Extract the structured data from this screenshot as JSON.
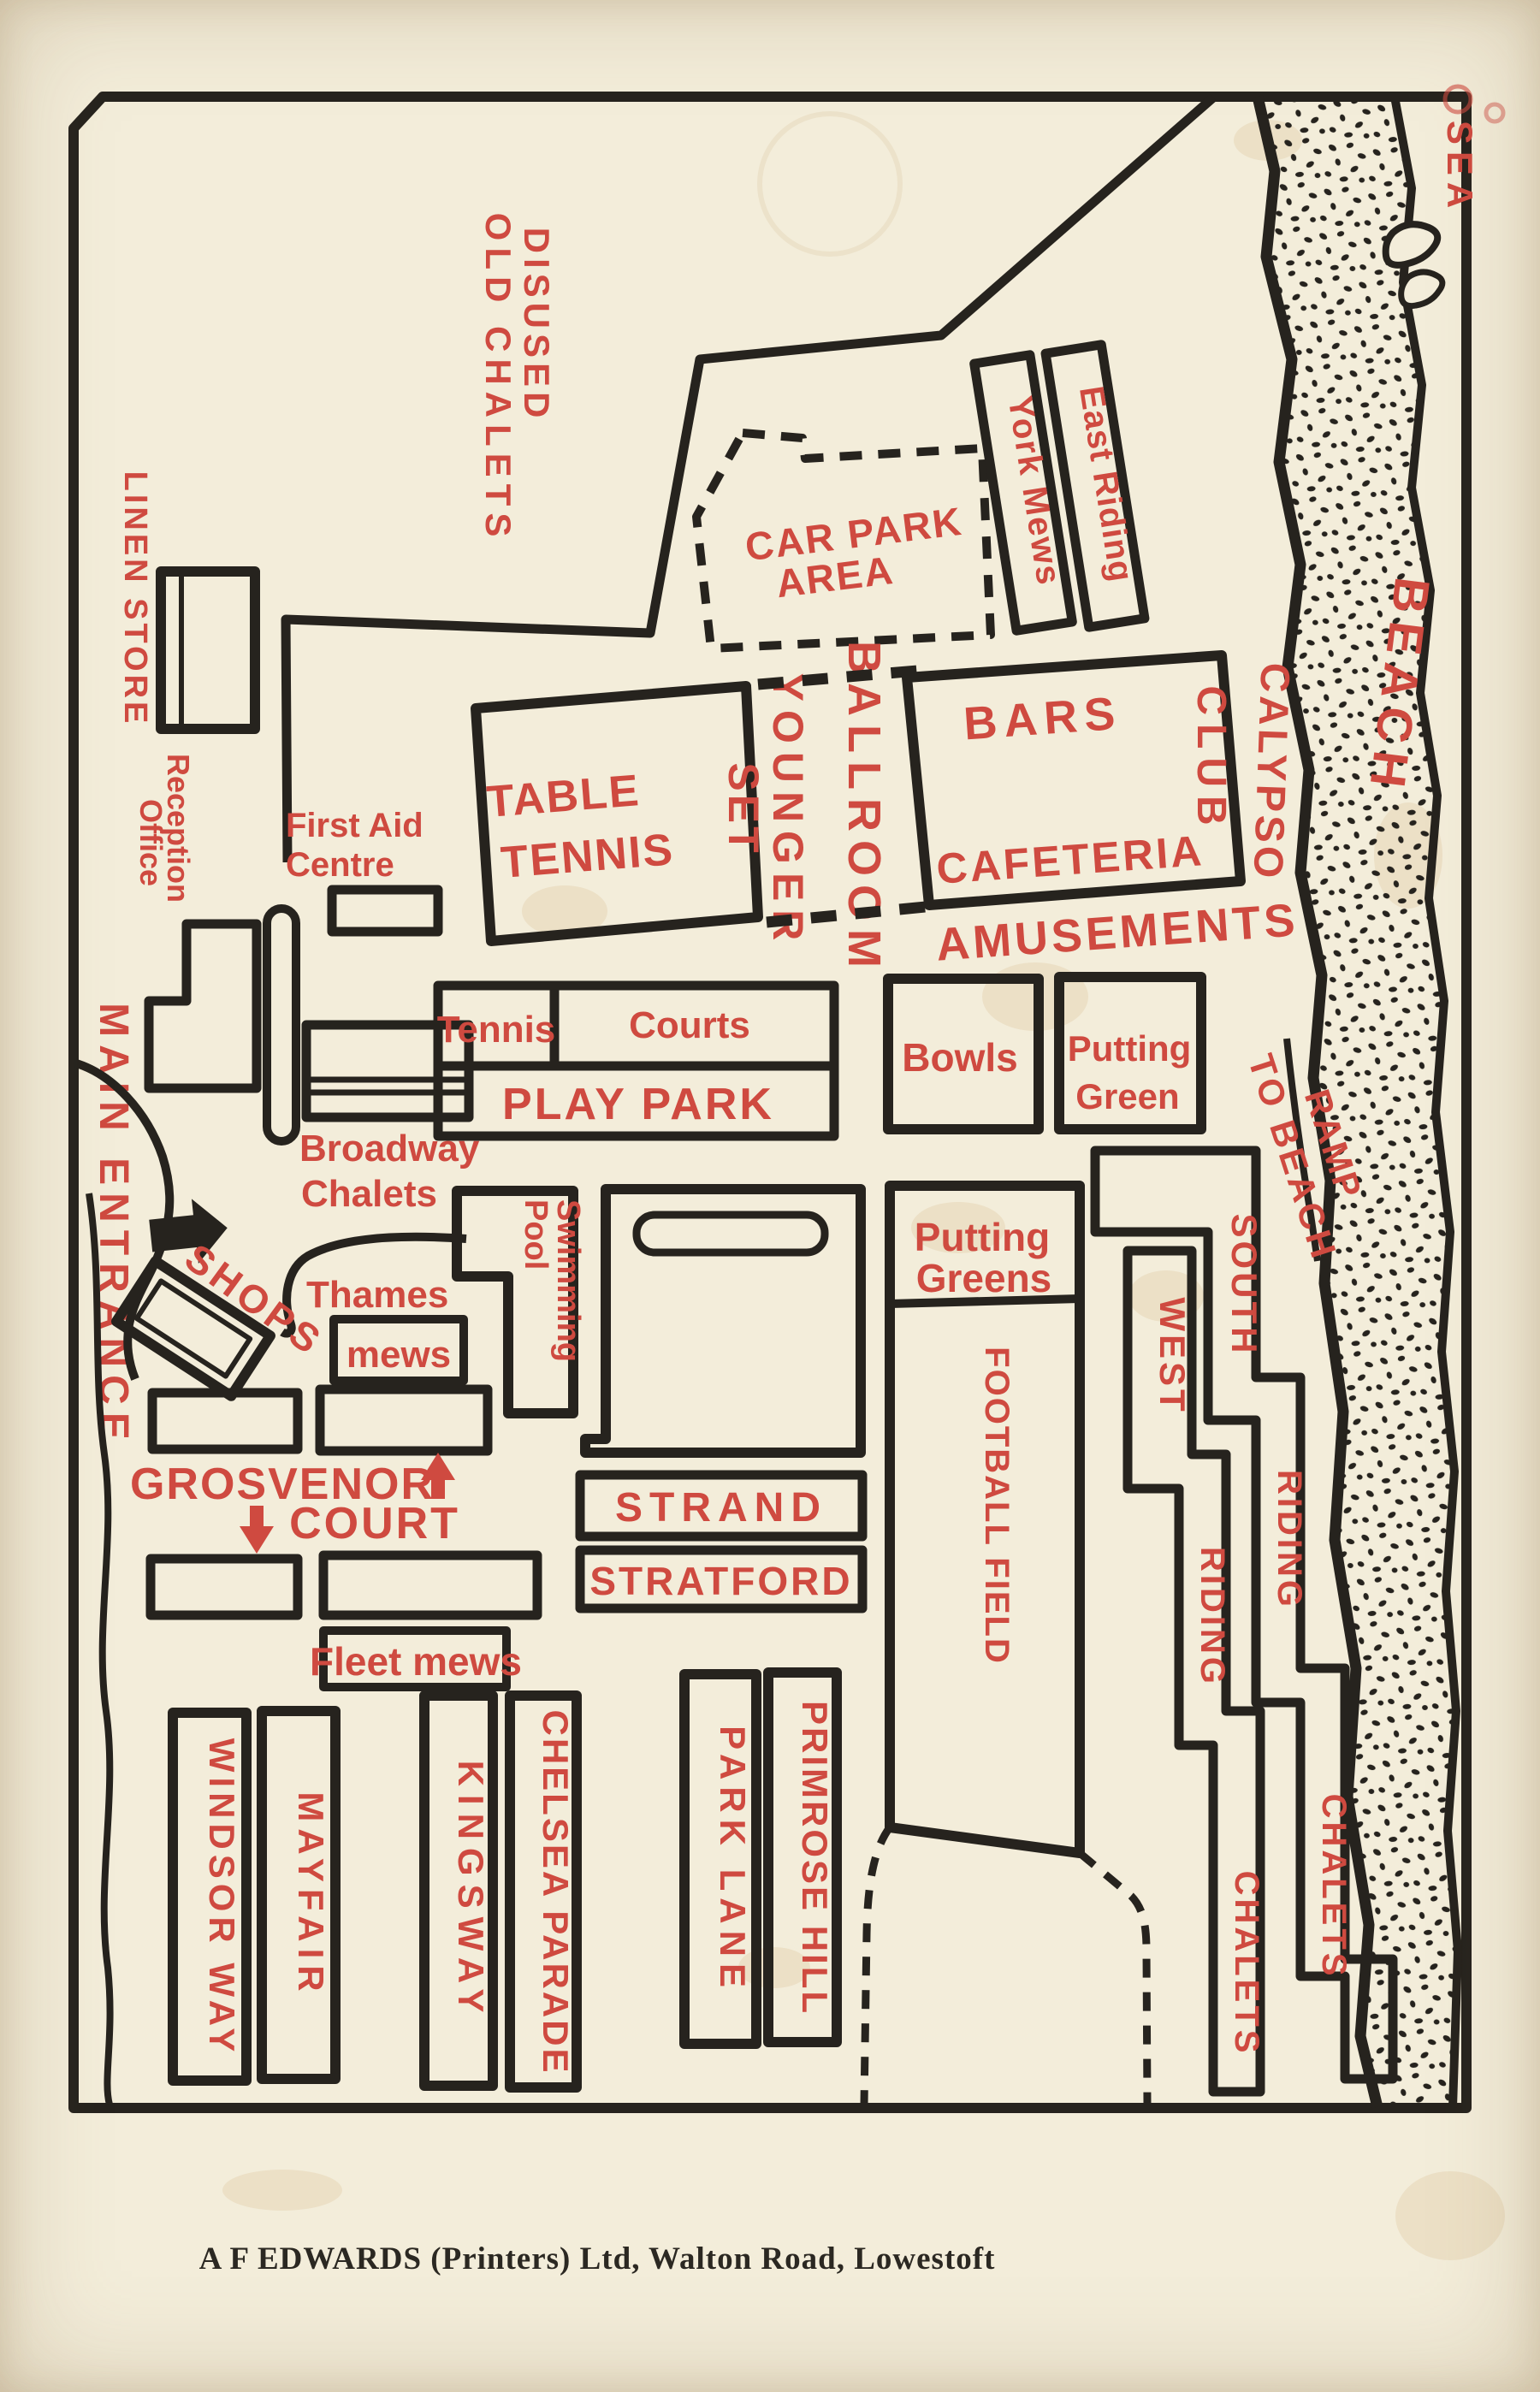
{
  "colors": {
    "paper": "#f3edda",
    "ink": "#26231e",
    "red": "#cf4a40"
  },
  "map": {
    "labels": {
      "sea": "SEA",
      "beach": "BEACH",
      "disused_line1": "DISUSED",
      "disused_line2": "OLD CHALETS",
      "car_park_line1": "CAR PARK",
      "car_park_line2": "AREA",
      "york_mews": "York Mews",
      "east_riding": "East Riding",
      "linen_store": "LINEN STORE",
      "reception_line1": "Reception",
      "reception_line2": "Office",
      "first_aid_line1": "First Aid",
      "first_aid_line2": "Centre",
      "main_entrance": "MAIN ENTRANCE",
      "table_tennis_line1": "TABLE",
      "table_tennis_line2": "TENNIS",
      "younger_set_line1": "YOUNGER",
      "younger_set_line2": "SET",
      "ballroom": "BALLROOM",
      "bars": "BARS",
      "club": "CLUB",
      "calypso": "CALYPSO",
      "cafeteria": "CAFETERIA",
      "amusements": "AMUSEMENTS",
      "tennis": "Tennis",
      "courts": "Courts",
      "play_park": "PLAY PARK",
      "bowls": "Bowls",
      "putting_green_line1": "Putting",
      "putting_green_line2": "Green",
      "broadway_line1": "Broadway",
      "broadway_line2": "Chalets",
      "shops": "SHOPS",
      "thames": "Thames",
      "mews": "mews",
      "swimming_line1": "Swimming",
      "swimming_line2": "Pool",
      "putting_greens_line1": "Putting",
      "putting_greens_line2": "Greens",
      "football_field": "FOOTBALL FIELD",
      "ramp_line1": "RAMP",
      "ramp_line2": "TO BEACH",
      "south": "SOUTH",
      "west": "WEST",
      "riding_outer": "RIDING",
      "riding_inner": "RIDING",
      "chalets_outer": "CHALETS",
      "chalets_inner": "CHALETS",
      "grosvenor": "GROSVENOR",
      "court": "COURT",
      "fleet_mews": "Fleet mews",
      "strand": "STRAND",
      "stratford": "STRATFORD",
      "windsor_way": "WINDSOR WAY",
      "mayfair": "MAYFAIR",
      "kingsway": "KINGSWAY",
      "chelsea_parade": "CHELSEA PARADE",
      "park_lane": "PARK LANE",
      "primrose_hill": "PRIMROSE HILL"
    }
  },
  "footer": {
    "credit": "A F EDWARDS (Printers) Ltd, Walton Road, Lowestoft"
  }
}
